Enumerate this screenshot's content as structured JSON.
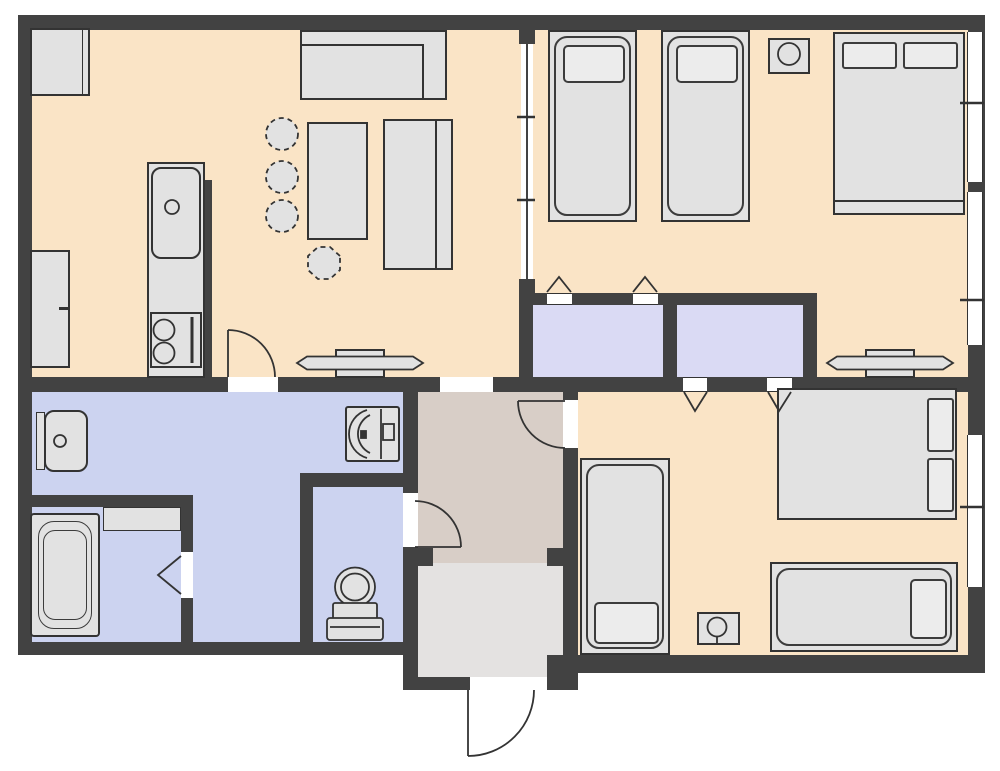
{
  "title": "apartment-floor-plan",
  "colors": {
    "wall": "#424242",
    "line": "#333333",
    "paper": "#ffffff",
    "floor-living": "#fae4c6",
    "floor-bath": "#ccd3f0",
    "floor-closet": "#dadaf4",
    "floor-hall": "#d8cec7",
    "floor-entry": "#e4e2e1",
    "furniture": "#e2e2e2"
  },
  "rooms": [
    {
      "name": "living-dining-kitchen",
      "floor": "peach"
    },
    {
      "name": "bedroom-top-right",
      "floor": "peach"
    },
    {
      "name": "bedroom-bottom-right",
      "floor": "peach"
    },
    {
      "name": "bathroom-laundry-room",
      "floor": "periwinkle"
    },
    {
      "name": "bathtub-room",
      "floor": "periwinkle"
    },
    {
      "name": "toilet-room",
      "floor": "periwinkle"
    },
    {
      "name": "hallway",
      "floor": "taupe"
    },
    {
      "name": "entry-vestibule",
      "floor": "gray"
    },
    {
      "name": "closet-1",
      "floor": "lavender"
    },
    {
      "name": "closet-2",
      "floor": "lavender"
    }
  ],
  "furniture": [
    "corner-cabinet",
    "kitchen-sink-counter",
    "stove-two-burners",
    "refrigerator",
    "sofa-large",
    "sofa-small",
    "coffee-table",
    "round-chair",
    "round-chair",
    "round-chair",
    "octagonal-chair",
    "tv-on-stand-living",
    "tv-on-stand-bedroom",
    "single-bed",
    "single-bed",
    "double-bed",
    "nightstand-with-lamp",
    "single-bed-vertical",
    "double-bed-2",
    "single-bed-horizontal",
    "nightstand-with-lamp-2",
    "vanity-sink",
    "washing-machine",
    "bathtub",
    "bathroom-counter",
    "toilet"
  ],
  "doors": [
    "bathroom-door-from-living",
    "toilet-door-to-hallway",
    "bedroom2-door-from-hallway",
    "entry-door",
    "bathtub-room-folding-door",
    "closet1-bifold-a",
    "closet1-bifold-b",
    "closet2-bifold-a",
    "closet2-bifold-b",
    "living-bedroom1-sliding-partition"
  ],
  "windows": [
    "right-wall-window-1",
    "right-wall-window-2",
    "right-wall-window-3"
  ]
}
